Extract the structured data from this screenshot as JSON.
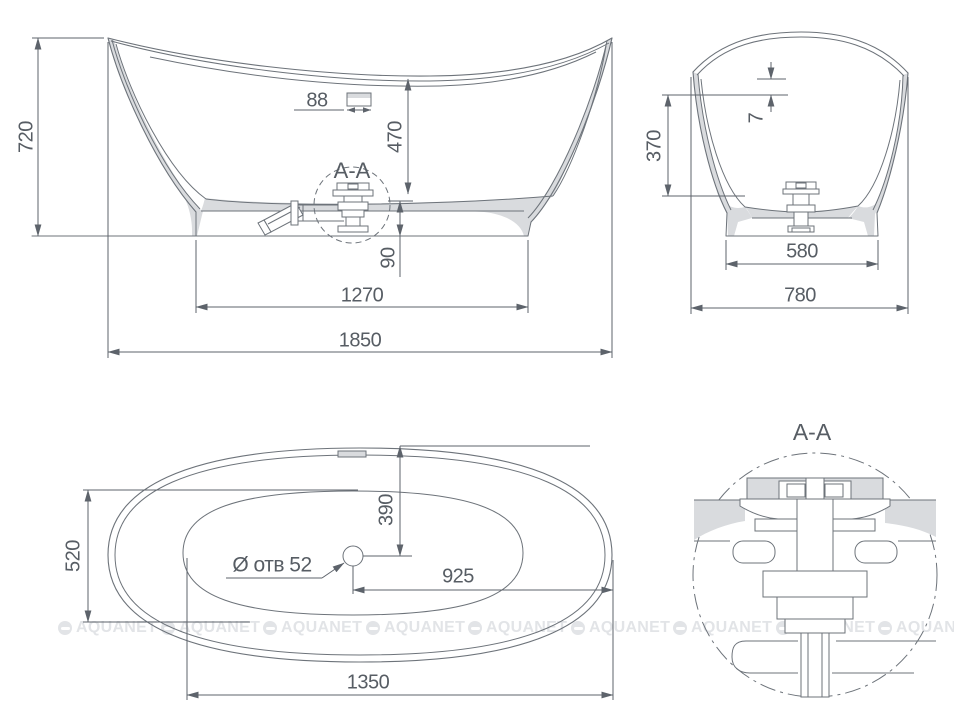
{
  "views": {
    "front": {
      "dim_overall_height": "720",
      "dim_overflow_width": "88",
      "dim_depth_to_floor": "470",
      "section_label": "A-A",
      "dim_drain_height": "90",
      "dim_base_length": "1270",
      "dim_overall_length": "1850"
    },
    "side": {
      "dim_rim_step": "7",
      "dim_depth": "370",
      "dim_base_width": "580",
      "dim_overall_width": "780"
    },
    "plan": {
      "dim_inner_width": "520",
      "dim_drain_from_top_edge": "390",
      "drain_hole_label": "Ø отв 52",
      "dim_drain_from_end": "925",
      "dim_base_length": "1350"
    },
    "detail": {
      "title": "A-A"
    }
  },
  "watermark": {
    "text": "AQUANET"
  },
  "colors": {
    "line": "#6d737a",
    "dim_text": "#575d64",
    "material_fill": "#d9dbde",
    "watermark": "#e2e4e7",
    "background": "#ffffff"
  }
}
